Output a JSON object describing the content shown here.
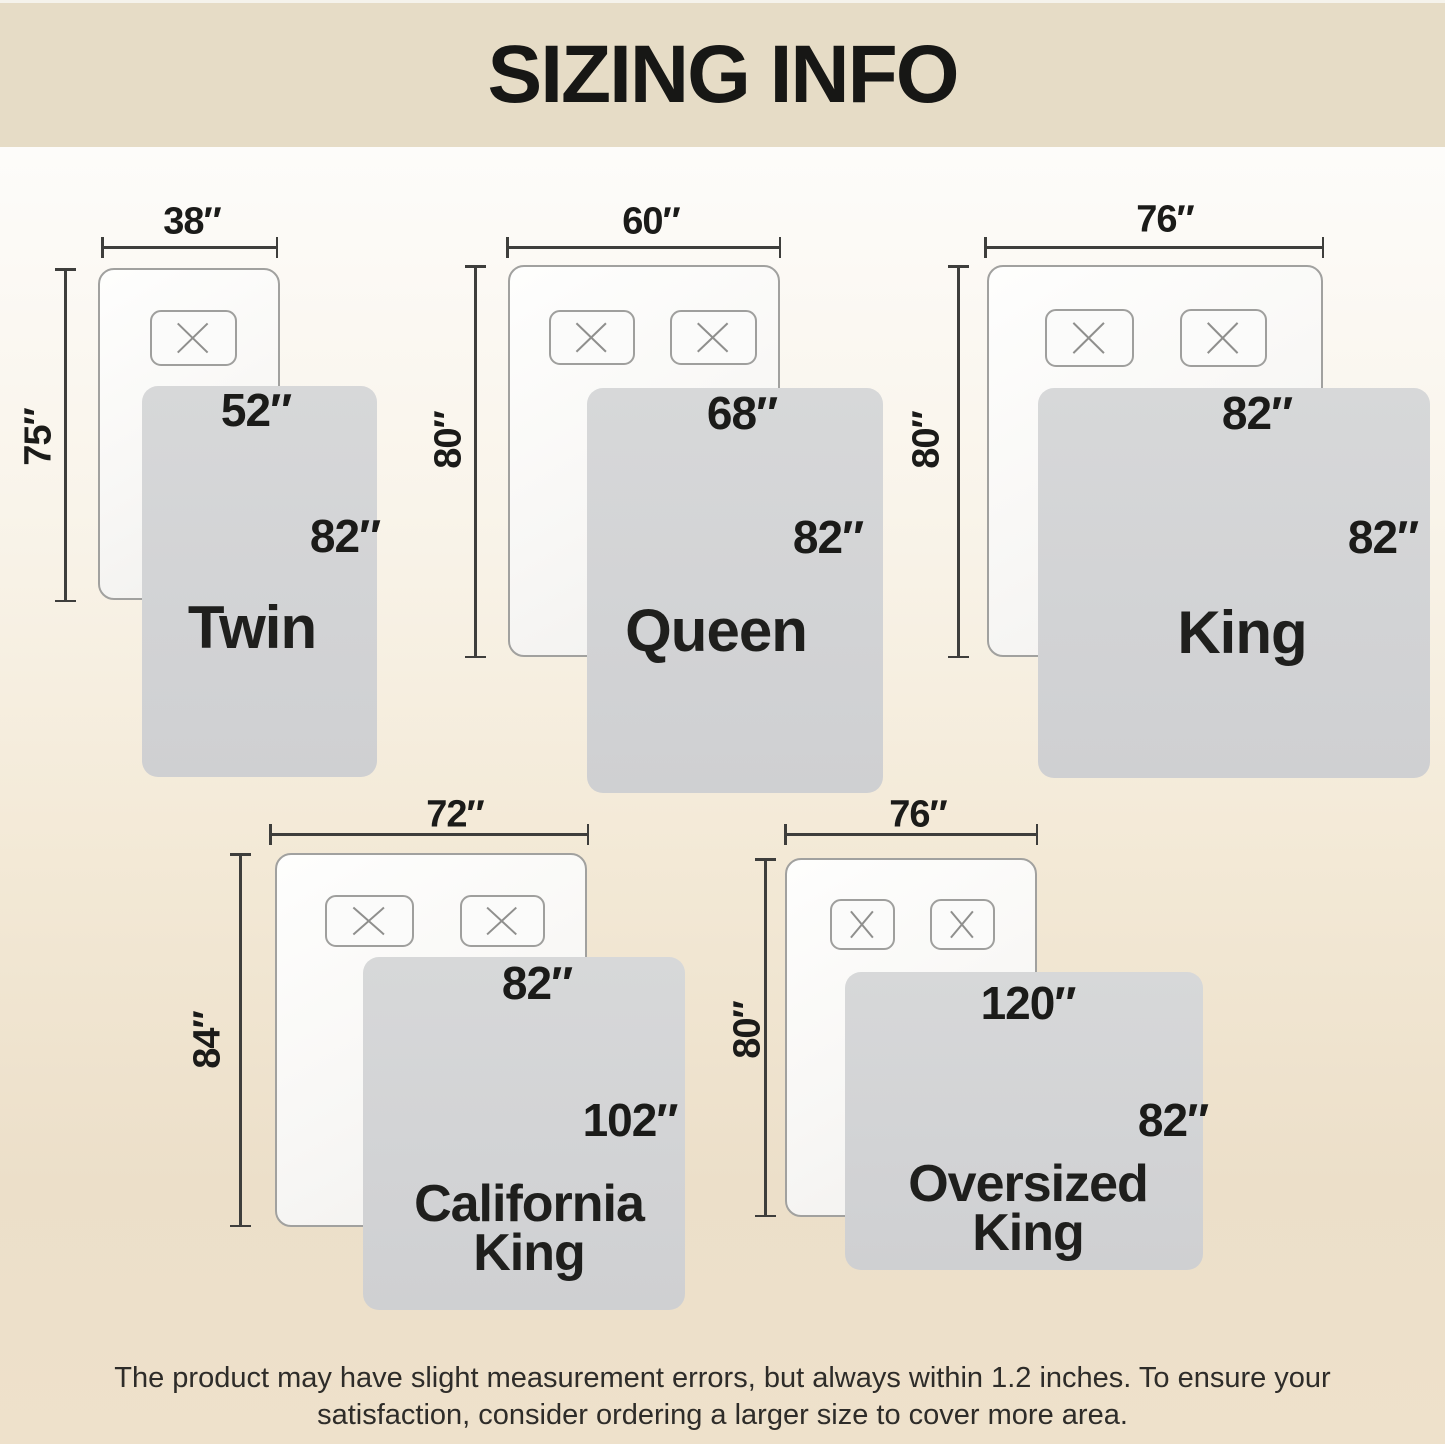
{
  "header": {
    "title": "SIZING INFO"
  },
  "footer": {
    "line1": "The product may have slight measurement errors, but always within 1.2 inches. To ensure your",
    "line2": "satisfaction, consider ordering a larger size to cover more area."
  },
  "colors": {
    "header_bg": "#e6dcc6",
    "background_top": "#fdfcfa",
    "background_bottom": "#eee1cb",
    "blanket_gray": "#d3d4d5",
    "mattress_fill": "#fbfbfa",
    "mattress_border": "#a1a19f",
    "dimension_line": "#3e3e3c",
    "text": "#1b1b19"
  },
  "icons": {
    "pillow_stitch": "x-cross"
  },
  "diagrams": [
    {
      "name_lines": [
        "Twin"
      ],
      "bed_width": "38″",
      "bed_length": "75″",
      "blanket_width": "52″",
      "blanket_length": "82″",
      "pillows": 1
    },
    {
      "name_lines": [
        "Queen"
      ],
      "bed_width": "60″",
      "bed_length": "80″",
      "blanket_width": "68″",
      "blanket_length": "82″",
      "pillows": 2
    },
    {
      "name_lines": [
        "King"
      ],
      "bed_width": "76″",
      "bed_length": "80″",
      "blanket_width": "82″",
      "blanket_length": "82″",
      "pillows": 2
    },
    {
      "name_lines": [
        "California",
        "King"
      ],
      "bed_width": "72″",
      "bed_length": "84″",
      "blanket_width": "82″",
      "blanket_length": "102″",
      "pillows": 2
    },
    {
      "name_lines": [
        "Oversized",
        "King"
      ],
      "bed_width": "76″",
      "bed_length": "80″",
      "blanket_width": "120″",
      "blanket_length": "82″",
      "pillows": 2
    }
  ]
}
